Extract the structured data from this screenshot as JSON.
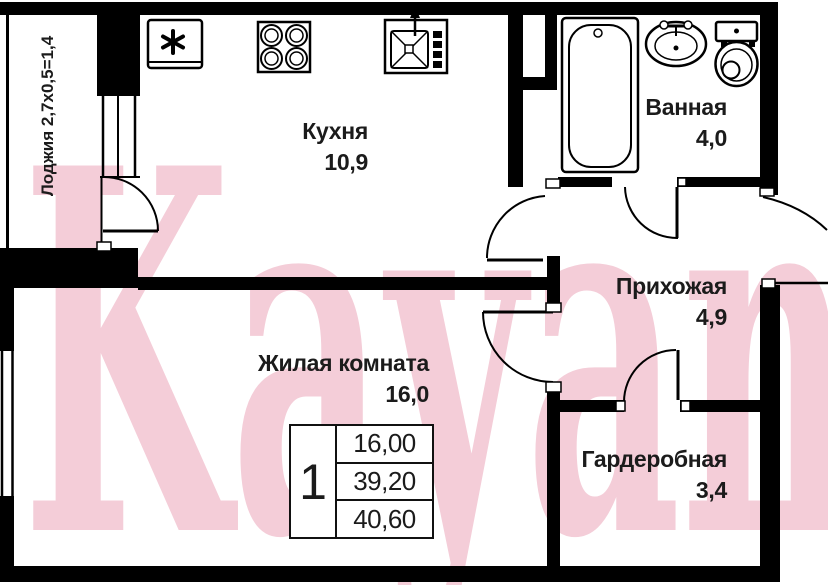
{
  "plan_title": "1-room apartment floor plan",
  "watermark": {
    "text": "Kayan",
    "color": "#f4cdd8"
  },
  "rooms": {
    "loggia": {
      "label": "Лоджия 2,7х0,5=1,4"
    },
    "kitchen": {
      "name": "Кухня",
      "area": "10,9"
    },
    "bathroom": {
      "name": "Ванная",
      "area": "4,0"
    },
    "hallway": {
      "name": "Прихожая",
      "area": "4,9"
    },
    "living_room": {
      "name": "Жилая комната",
      "area": "16,0"
    },
    "wardrobe": {
      "name": "Гардеробная",
      "area": "3,4"
    }
  },
  "summary_table": {
    "rooms_count": "1",
    "living_area": "16,00",
    "area_without_loggia": "39,20",
    "total_area": "40,60"
  },
  "icons": [
    "fridge-icon",
    "stove-icon",
    "kitchen-sink-icon",
    "bathtub-icon",
    "washbasin-icon",
    "toilet-icon"
  ],
  "colors": {
    "wall": "#000000",
    "background": "#ffffff",
    "watermark_pink": "#f4cdd8"
  }
}
